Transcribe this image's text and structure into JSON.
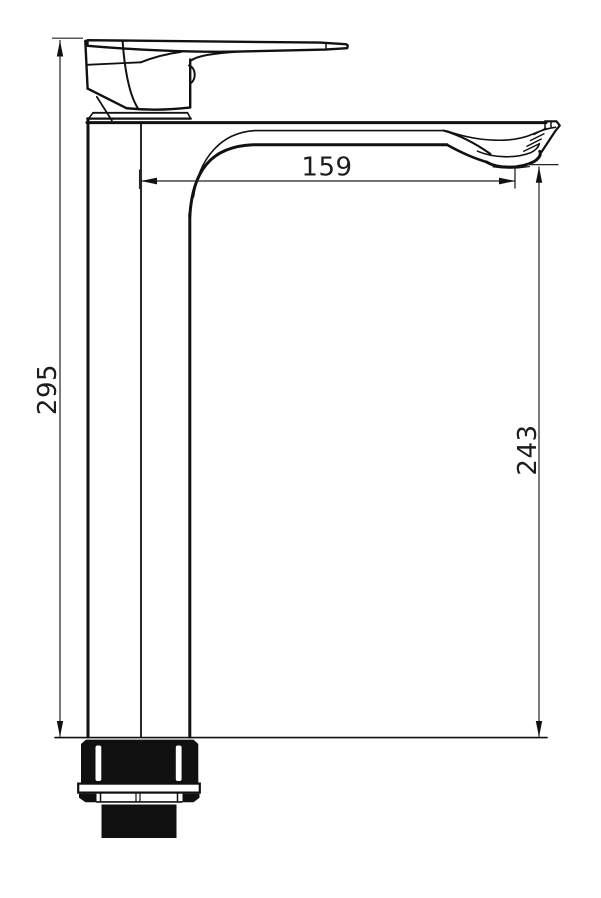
{
  "page": {
    "background": "#ffffff"
  },
  "diagram": {
    "type": "technical-drawing",
    "subject": "tall single-lever basin mixer faucet, side elevation with dimensions",
    "line_color": "#111111",
    "reference_line_color": "#7a7a7a",
    "dimensions": [
      {
        "id": "overall-height",
        "label": "295",
        "orientation": "vertical",
        "position": "left",
        "from": "top of lever",
        "to": "mounting surface"
      },
      {
        "id": "spout-reach",
        "label": "159",
        "orientation": "horizontal",
        "position": "top",
        "from": "body front edge",
        "to": "spout outlet"
      },
      {
        "id": "spout-outlet-height",
        "label": "243",
        "orientation": "vertical",
        "position": "right",
        "from": "underside of spout outlet",
        "to": "mounting surface"
      }
    ]
  }
}
